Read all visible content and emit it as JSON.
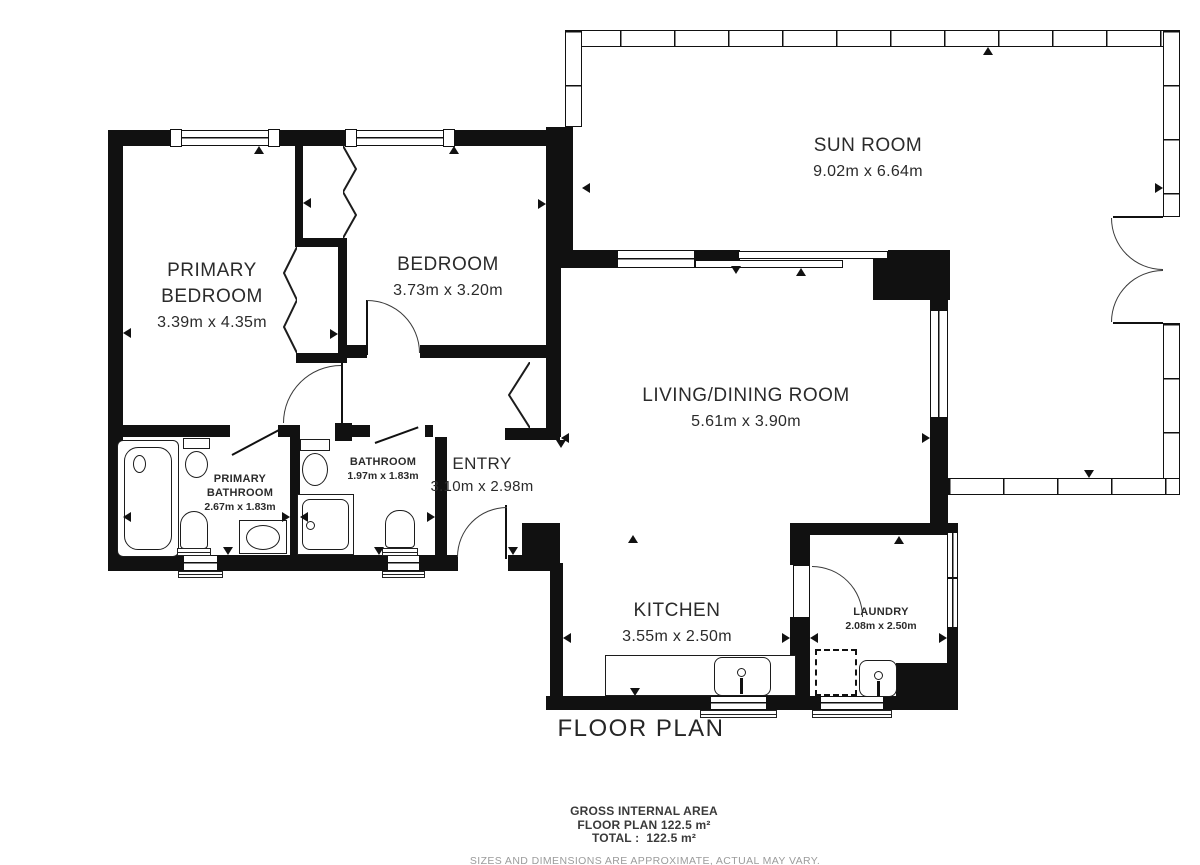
{
  "plan": {
    "title": "FLOOR PLAN",
    "rooms": {
      "sun_room": {
        "name": "SUN ROOM",
        "dims": "9.02m x 6.64m"
      },
      "primary_bedroom": {
        "line1": "PRIMARY",
        "line2": "BEDROOM",
        "dims": "3.39m x 4.35m"
      },
      "bedroom": {
        "name": "BEDROOM",
        "dims": "3.73m x 3.20m"
      },
      "living_dining": {
        "name": "LIVING/DINING ROOM",
        "dims": "5.61m x 3.90m"
      },
      "primary_bathroom": {
        "line1": "PRIMARY",
        "line2": "BATHROOM",
        "dims": "2.67m x 1.83m"
      },
      "bathroom": {
        "name": "BATHROOM",
        "dims": "1.97m x 1.83m"
      },
      "entry": {
        "name": "ENTRY",
        "dims": "3.10m x 2.98m"
      },
      "kitchen": {
        "name": "KITCHEN",
        "dims": "3.55m x 2.50m"
      },
      "laundry": {
        "name": "LAUNDRY",
        "dims": "2.08m x 2.50m"
      }
    },
    "footer": {
      "area_heading": "GROSS INTERNAL AREA",
      "area_floor_plan": "FLOOR PLAN 122.5 m²",
      "area_total": "TOTAL :  122.5 m²",
      "disclaimer": "SIZES AND DIMENSIONS ARE APPROXIMATE, ACTUAL MAY VARY."
    },
    "colors": {
      "wall": "#111111",
      "text": "#2b2b2b",
      "muted": "#9b9b9b"
    }
  }
}
